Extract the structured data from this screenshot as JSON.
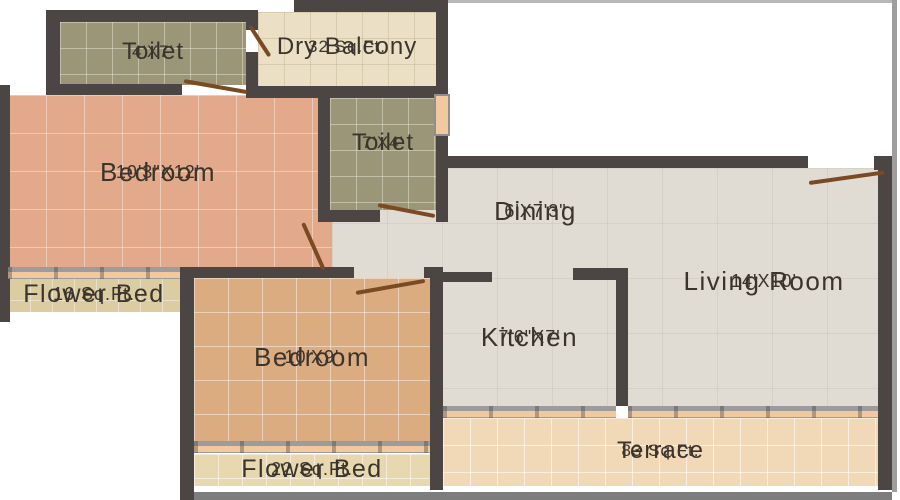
{
  "title": "2BHK Apartment Floor Plan",
  "rooms": {
    "toilet1": {
      "name": "Toilet",
      "dims": "4'X7'"
    },
    "dry_balcony": {
      "name": "Dry Balcony",
      "dims": "32 Sq.Ft."
    },
    "bedroom1": {
      "name": "Bedroom",
      "dims": "10'3\"X12'"
    },
    "toilet2": {
      "name": "Toilet",
      "dims": "7'X4'"
    },
    "dining": {
      "name": "Dining",
      "dims": "6'X7'3\""
    },
    "living_room": {
      "name": "Living Room",
      "dims": "14'X10'"
    },
    "flower_bed1": {
      "name": "Flower Bed",
      "dims": "16 Sq.Ft."
    },
    "bedroom2": {
      "name": "Bedroom",
      "dims": "10'X9'"
    },
    "kitchen": {
      "name": "Kitchen",
      "dims": "7'6\"X7'"
    },
    "terrace": {
      "name": "Terrace",
      "dims": "83 Sq.Ft."
    },
    "flower_bed2": {
      "name": "Flower Bed",
      "dims": "22 Sq.Ft."
    }
  },
  "palette": {
    "wall": "#4b4643",
    "bedroom1_floor": "#e2a98b",
    "bedroom2_floor": "#dcac81",
    "toilet_floor": "#9c9678",
    "balcony_floor": "#ebdfc6",
    "living_floor": "#e0dcd3",
    "terrace_floor": "#f1d9b8",
    "door_leaf": "#7a4a22",
    "window_fill": "#f3c89e"
  }
}
